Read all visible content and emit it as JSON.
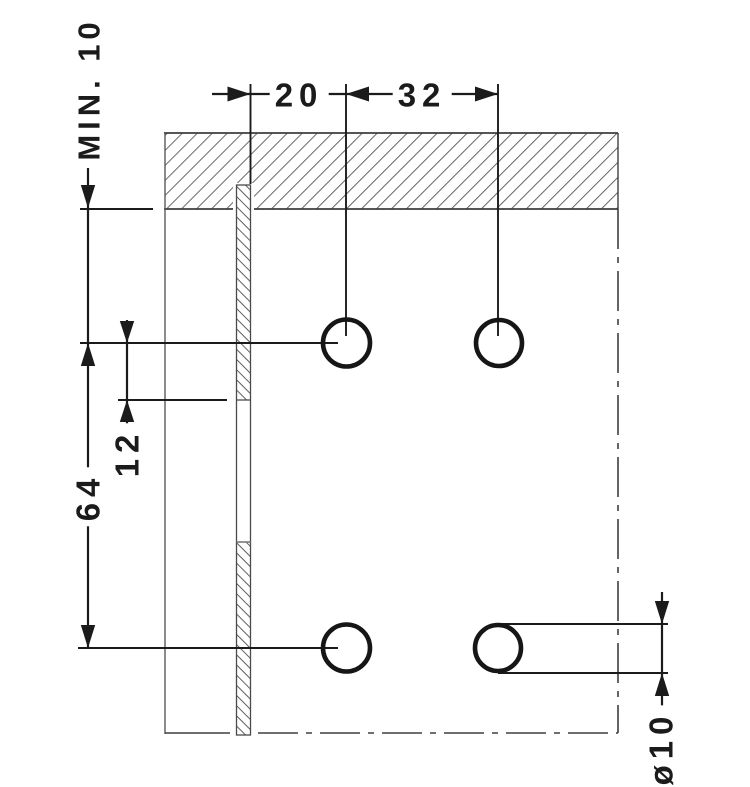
{
  "drawing": {
    "kind": "technical mounting drawing, section view with drilling dimensions",
    "labels": {
      "min_depth": "MIN. 10",
      "dim_20": "20",
      "dim_32": "32",
      "dim_64": "64",
      "dim_12": "12",
      "hole_diameter": "ø10"
    },
    "holes": {
      "count": 4,
      "diameter_label": "ø10"
    },
    "colors": {
      "dimension_line": "#1b1b1b",
      "outline": "#444444",
      "hatch": "#666666",
      "background": "#ffffff"
    }
  }
}
